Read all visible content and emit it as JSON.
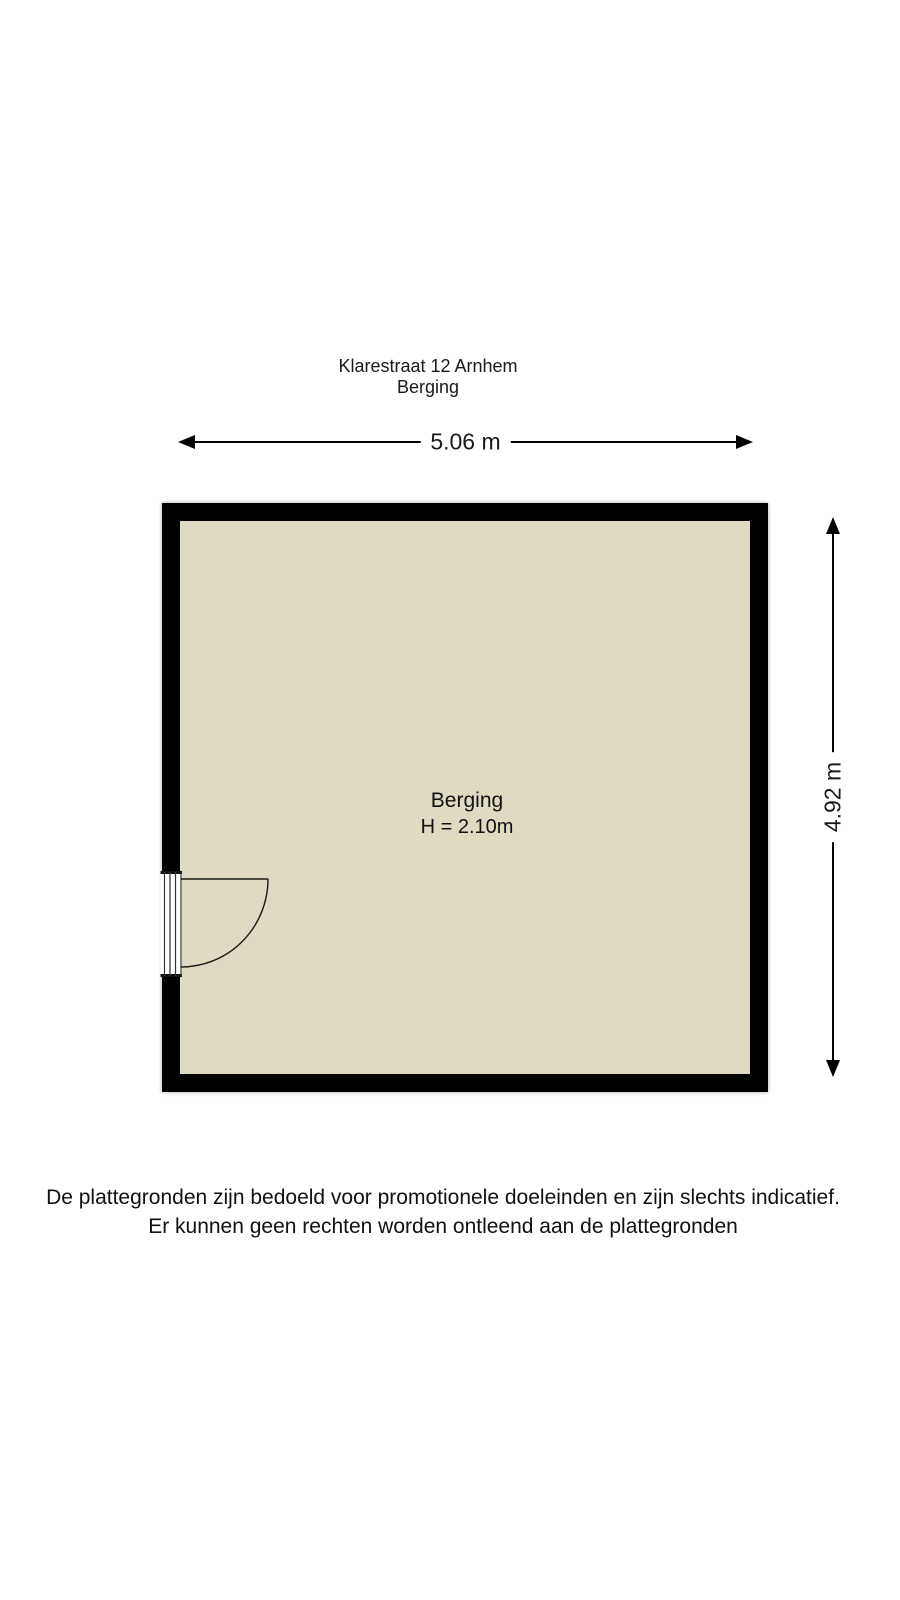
{
  "header": {
    "title": "Klarestraat 12 Arnhem",
    "subtitle": "Berging"
  },
  "floorplan": {
    "room": {
      "name": "Berging",
      "ceiling_height": "H = 2.10m"
    },
    "dimensions": {
      "width_label": "5.06 m",
      "height_label": "4.92 m"
    },
    "colors": {
      "wall": "#000000",
      "floor": "#e1dac3",
      "dimension_line": "#000000"
    },
    "icons": {
      "door": "quarter-circle-swing-arc",
      "dimension_arrows": "solid-triangle-arrowheads"
    }
  },
  "disclaimer": {
    "line1": "De plattegronden zijn bedoeld voor promotionele doeleinden en zijn slechts indicatief.",
    "line2": "Er kunnen geen rechten worden ontleend aan de plattegronden"
  }
}
